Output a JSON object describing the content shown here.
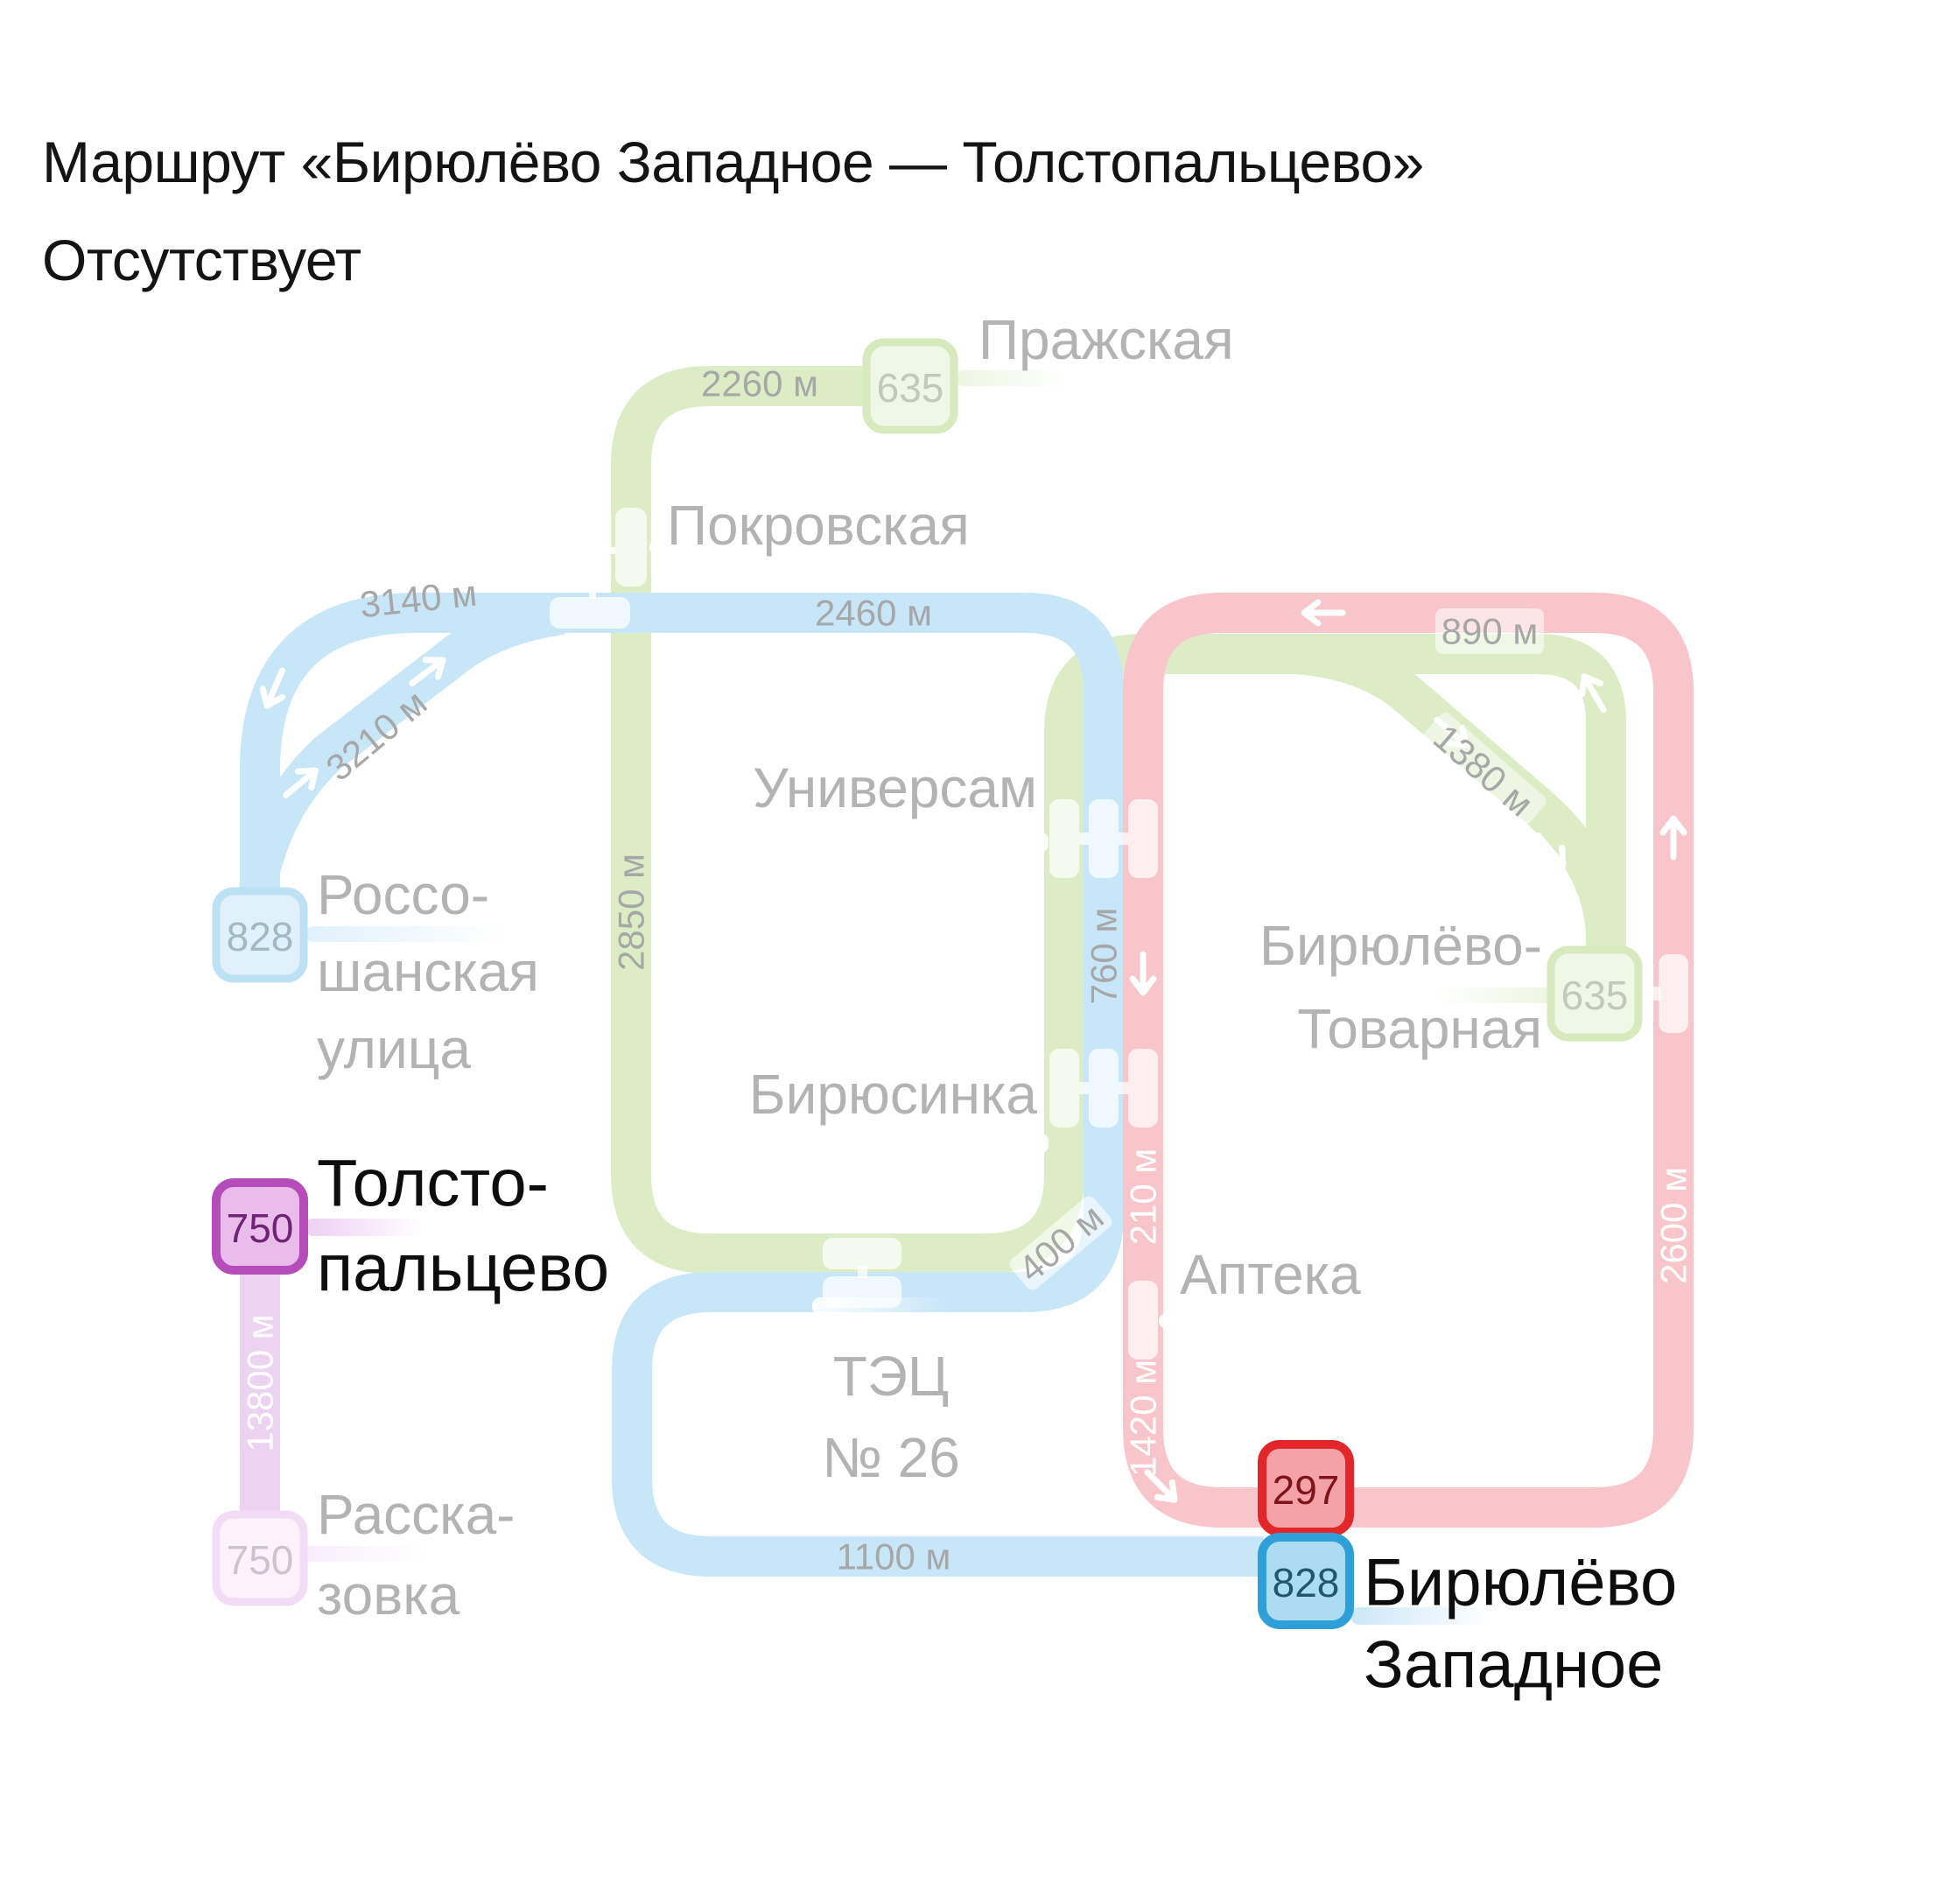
{
  "title": {
    "line1": "Маршрут «Бирюлёво Западное — Толстопальцево»",
    "line2": "Отсутствует"
  },
  "map": {
    "routes": {
      "green_635": {
        "number": "635",
        "line_color": "#dcedc6",
        "state": "faded"
      },
      "blue_828": {
        "number": "828",
        "line_color": "#c7e6f8",
        "active_badge_border": "#2f9fd8",
        "active_badge_fill": "#abdcf2"
      },
      "red_297": {
        "number": "297",
        "line_color": "#f8c6ca",
        "active_badge_border": "#e3262a",
        "active_badge_fill": "#f4a2a6"
      },
      "purple_750": {
        "number": "750",
        "line_color": "#edd3f2",
        "active_badge_border": "#b54cba",
        "active_badge_fill": "#e9bcec"
      }
    },
    "stations": {
      "prazhskaya": {
        "name": "Пражская"
      },
      "pokrovskaya": {
        "name": "Покровская"
      },
      "universam": {
        "name": "Универсам"
      },
      "biryusinka": {
        "name": "Бирюсинка"
      },
      "rossoshanskaya": {
        "lines": [
          "Россо-",
          "шанская",
          "улица"
        ]
      },
      "tolstopaltsevo": {
        "lines": [
          "Толсто-",
          "пальцево"
        ],
        "highlighted": true
      },
      "rasskazovka": {
        "lines": [
          "Расска-",
          "зовка"
        ]
      },
      "biryulyovo_tovarnaya": {
        "lines": [
          "Бирюлёво-",
          "Товарная"
        ]
      },
      "apteka": {
        "name": "Аптека"
      },
      "tec_26": {
        "lines": [
          "ТЭЦ",
          "№ 26"
        ]
      },
      "biryulyovo_zapadnoye": {
        "lines": [
          "Бирюлёво",
          "Западное"
        ],
        "highlighted": true
      }
    },
    "distances": {
      "d2260": "2260 м",
      "d3140": "3140 м",
      "d3210": "3210 м",
      "d2460": "2460 м",
      "d2850": "2850 м",
      "d890": "890 м",
      "d1380": "1380 м",
      "d760": "760 м",
      "d400": "400 м",
      "d210": "210 м",
      "d1420": "1420 м",
      "d2600": "2600 м",
      "d1100": "1100 м",
      "d13800": "13800 м"
    },
    "text_colors": {
      "station_faded": "#b3b3b3",
      "station_active": "#0d0d0d",
      "distance_faded": "#a7a7a7",
      "distance_on_line": "#ffffff"
    }
  }
}
